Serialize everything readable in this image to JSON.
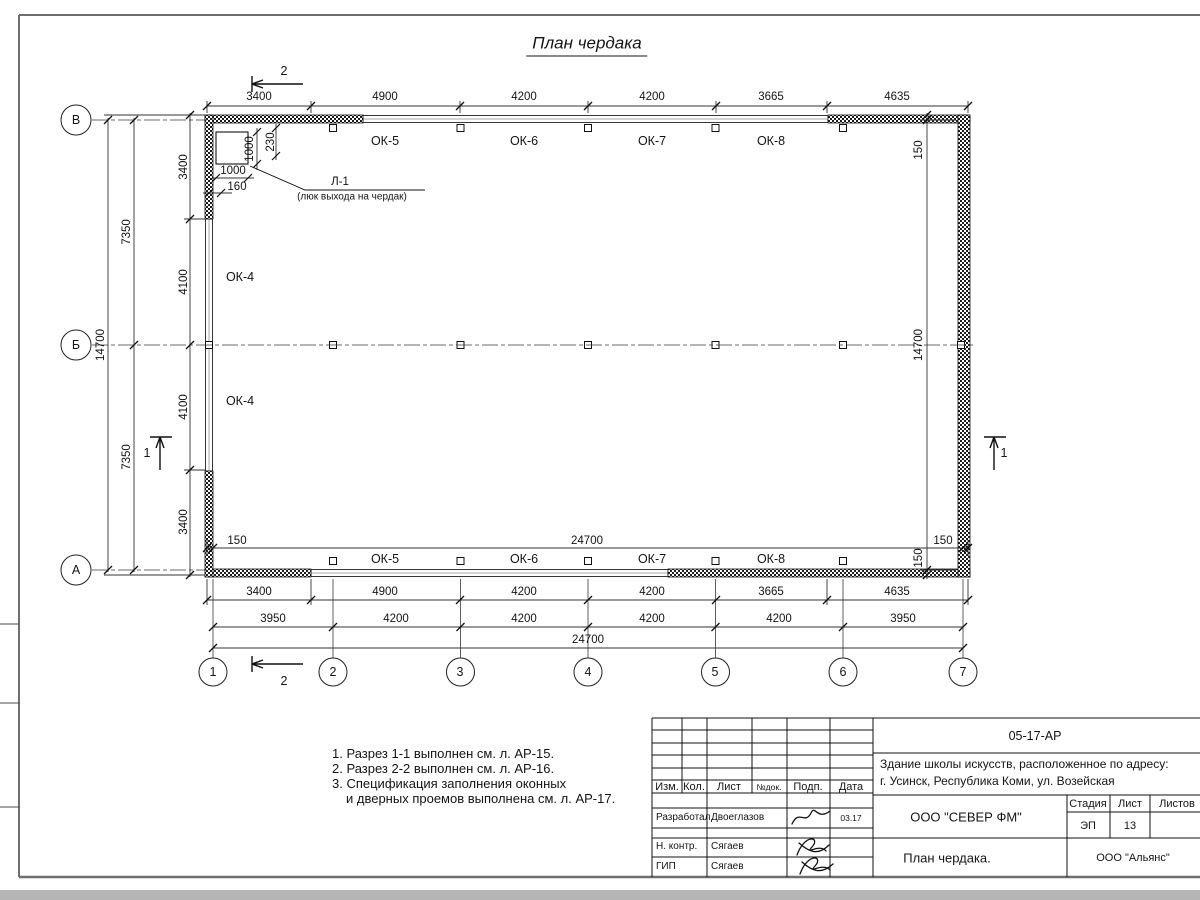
{
  "sheet": {
    "title": "План чердака"
  },
  "plan": {
    "dims": {
      "top": [
        "3400",
        "4900",
        "4200",
        "4200",
        "3665",
        "4635"
      ],
      "bottom_openings": [
        "3400",
        "4900",
        "4200",
        "4200",
        "3665",
        "4635"
      ],
      "bottom_axes": [
        "3950",
        "4200",
        "4200",
        "4200",
        "4200",
        "3950"
      ],
      "bottom_total": "24700",
      "inner_total": "24700",
      "offset": "150",
      "left_openings": [
        "3400",
        "4100",
        "4100",
        "3400"
      ],
      "left_half": [
        "7350",
        "7350"
      ],
      "left_total": "14700",
      "right_inner_total": "14700"
    },
    "windows": {
      "top": [
        "ОК-5",
        "ОК-6",
        "ОК-7",
        "ОК-8"
      ],
      "bottom": [
        "ОК-5",
        "ОК-6",
        "ОК-7",
        "ОК-8"
      ],
      "left": [
        "ОК-4",
        "ОК-4"
      ]
    },
    "hatch_door": {
      "label": "Л-1",
      "note": "(люк выхода на чердак)",
      "width": "1000",
      "height": "1000",
      "offset_a": "230",
      "offset_b": "160"
    },
    "axes": {
      "bottom": [
        "1",
        "2",
        "3",
        "4",
        "5",
        "6",
        "7"
      ],
      "left": [
        "В",
        "Б",
        "А"
      ]
    },
    "sections": {
      "one": "1",
      "two": "2"
    }
  },
  "notes": {
    "n1": "1. Разрез 1-1 выполнен см. л. АР-15.",
    "n2": "2. Разрез 2-2 выполнен см. л. АР-16.",
    "n3": "3. Спецификация заполнения оконных",
    "n4": "и дверных проемов выполнена см. л. АР-17."
  },
  "stamp": {
    "doc_number": "05-17-АР",
    "project_line1": "Здание школы искусств, расположенное по адресу:",
    "project_line2": "г. Усинск, Республика Коми, ул. Возейская",
    "cols": {
      "izm": "Изм.",
      "kol": "Кол.",
      "list": "Лист",
      "ndok": "№док.",
      "podp": "Подп.",
      "data": "Дата"
    },
    "rows": [
      {
        "role": "Разработал",
        "name": "Двоеглазов",
        "date": "03.17"
      },
      {
        "role": "Н. контр.",
        "name": "Сягаев",
        "date": ""
      },
      {
        "role": "ГИП",
        "name": "Сягаев",
        "date": ""
      }
    ],
    "company": "ООО \"СЕВЕР ФМ\"",
    "stage_label": "Стадия",
    "sheet_label": "Лист",
    "sheets_label": "Листов",
    "stage": "ЭП",
    "sheet_no": "13",
    "drawing_title": "План чердака.",
    "contractor": "ООО \"Альянс\""
  }
}
